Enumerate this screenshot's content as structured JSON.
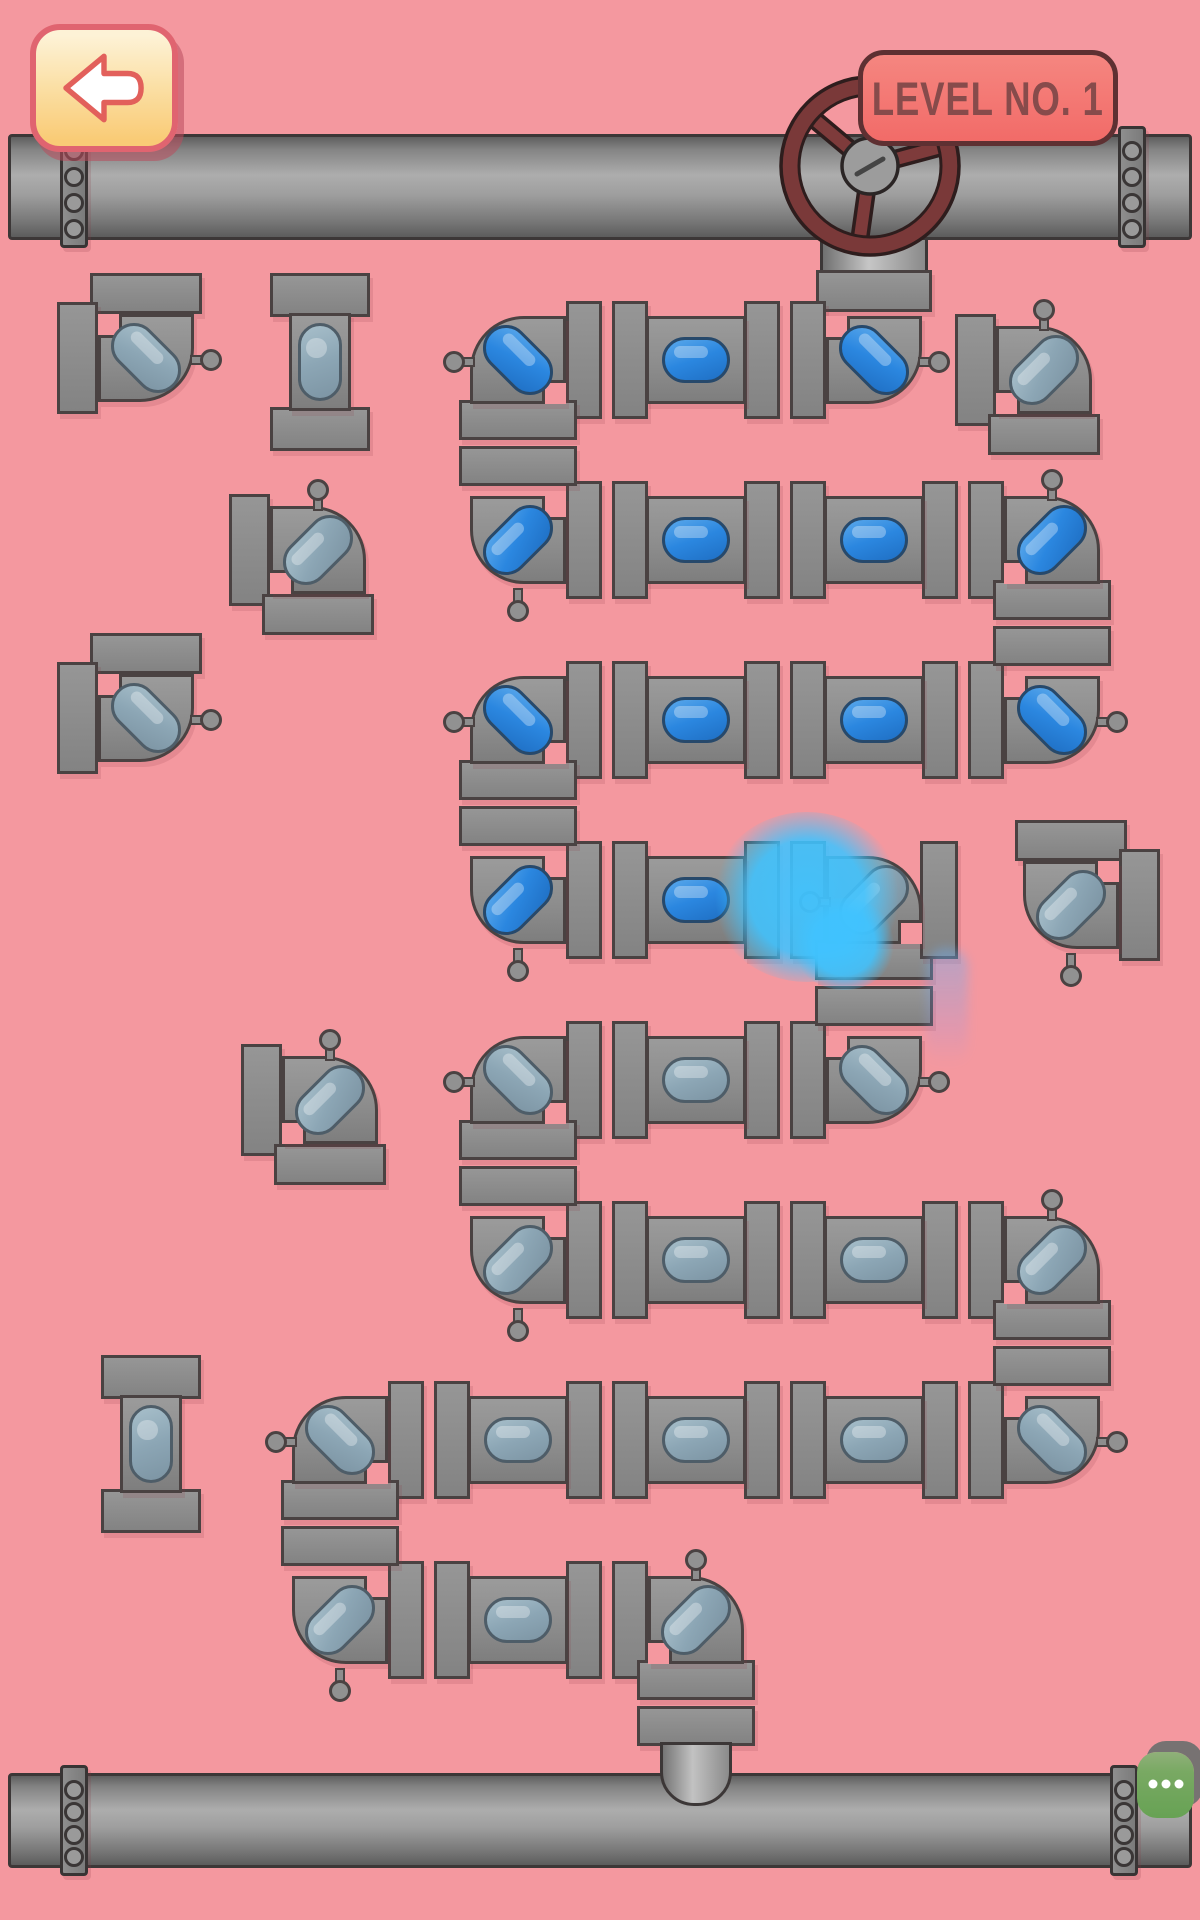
{
  "hud": {
    "back_button": {
      "icon": "arrow-left"
    },
    "level_badge": {
      "text": "LEVEL NO. 1"
    },
    "chat_button": {
      "icon": "ellipsis",
      "dot_count": 3
    }
  },
  "colors": {
    "background": "#F4989F",
    "pipe_outline": "#4A4242",
    "pipe_gray": "#8D8D8D",
    "water_filled": "#2B87E0",
    "water_empty": "#8CA6B5",
    "splash_cyan": "#3EC0FF",
    "valve_red": "#7A3939",
    "badge_fill": "#F2716C",
    "badge_border": "#5E3032",
    "badge_text": "#874B4B",
    "back_border": "#E06470",
    "back_fill": "#FBDFA4",
    "chat_green": "#67A254"
  },
  "scene": {
    "width": 1200,
    "height": 1920,
    "main_pipes": [
      {
        "name": "top-pipe",
        "x": 8,
        "y": 134,
        "w": 1184,
        "h": 106,
        "bands": [
          60,
          1118
        ]
      },
      {
        "name": "bottom-pipe",
        "x": 8,
        "y": 1773,
        "w": 1184,
        "h": 95,
        "bands": [
          60,
          1110
        ]
      }
    ],
    "valve": {
      "cx": 870,
      "cy": 166,
      "r": 89,
      "spokes": [
        140,
        15,
        262
      ],
      "stem": {
        "x": 820,
        "y": 200,
        "w": 108,
        "h": 74
      },
      "flange": {
        "x": 816,
        "y": 270,
        "w": 116,
        "h": 42
      }
    },
    "outlet": {
      "x": 660,
      "y": 1742,
      "w": 72,
      "h": 64
    },
    "joints": [
      {
        "t": "h",
        "x": 607,
        "y": 360
      },
      {
        "t": "h",
        "x": 785,
        "y": 360
      },
      {
        "t": "h",
        "x": 607,
        "y": 540
      },
      {
        "t": "h",
        "x": 785,
        "y": 540
      },
      {
        "t": "h",
        "x": 963,
        "y": 540
      },
      {
        "t": "h",
        "x": 607,
        "y": 720
      },
      {
        "t": "h",
        "x": 785,
        "y": 720
      },
      {
        "t": "h",
        "x": 963,
        "y": 720
      },
      {
        "t": "h",
        "x": 607,
        "y": 900
      },
      {
        "t": "h",
        "x": 785,
        "y": 900
      },
      {
        "t": "h",
        "x": 607,
        "y": 1080
      },
      {
        "t": "h",
        "x": 785,
        "y": 1080
      },
      {
        "t": "h",
        "x": 607,
        "y": 1260
      },
      {
        "t": "h",
        "x": 785,
        "y": 1260
      },
      {
        "t": "h",
        "x": 963,
        "y": 1260
      },
      {
        "t": "h",
        "x": 429,
        "y": 1440
      },
      {
        "t": "h",
        "x": 607,
        "y": 1440
      },
      {
        "t": "h",
        "x": 785,
        "y": 1440
      },
      {
        "t": "h",
        "x": 963,
        "y": 1440
      },
      {
        "t": "h",
        "x": 429,
        "y": 1620
      },
      {
        "t": "h",
        "x": 607,
        "y": 1620
      },
      {
        "t": "v",
        "x": 518,
        "y": 443
      },
      {
        "t": "v",
        "x": 1052,
        "y": 623
      },
      {
        "t": "v",
        "x": 518,
        "y": 803
      },
      {
        "t": "v",
        "x": 874,
        "y": 983
      },
      {
        "t": "v",
        "x": 518,
        "y": 1163
      },
      {
        "t": "v",
        "x": 1052,
        "y": 1343
      },
      {
        "t": "v",
        "x": 340,
        "y": 1523
      },
      {
        "t": "v",
        "x": 696,
        "y": 1703
      }
    ],
    "stub_flanges": [
      {
        "x": 920,
        "y": 841,
        "w": 38,
        "h": 118
      }
    ],
    "pieces": [
      {
        "t": "e",
        "x": 518,
        "y": 360,
        "c": "tl",
        "pin": "left",
        "f": true
      },
      {
        "t": "s",
        "x": 696,
        "y": 360,
        "f": true
      },
      {
        "t": "e",
        "x": 874,
        "y": 360,
        "c": "br",
        "pin": "right",
        "f": true
      },
      {
        "t": "e",
        "x": 518,
        "y": 540,
        "c": "bl",
        "pin": "bottom",
        "f": true
      },
      {
        "t": "s",
        "x": 696,
        "y": 540,
        "f": true
      },
      {
        "t": "s",
        "x": 874,
        "y": 540,
        "f": true
      },
      {
        "t": "e",
        "x": 1052,
        "y": 540,
        "c": "tr",
        "pin": "top",
        "f": true
      },
      {
        "t": "e",
        "x": 1052,
        "y": 720,
        "c": "br",
        "pin": "right",
        "f": true
      },
      {
        "t": "s",
        "x": 874,
        "y": 720,
        "f": true
      },
      {
        "t": "s",
        "x": 696,
        "y": 720,
        "f": true
      },
      {
        "t": "e",
        "x": 518,
        "y": 720,
        "c": "tl",
        "pin": "left",
        "f": true
      },
      {
        "t": "e",
        "x": 518,
        "y": 900,
        "c": "bl",
        "pin": "bottom",
        "f": true
      },
      {
        "t": "s",
        "x": 696,
        "y": 900,
        "f": true
      },
      {
        "t": "e",
        "x": 874,
        "y": 900,
        "c": "tr",
        "pin": "left",
        "f": false,
        "notch": "br"
      },
      {
        "t": "e",
        "x": 874,
        "y": 1080,
        "c": "br",
        "pin": "right",
        "f": false
      },
      {
        "t": "s",
        "x": 696,
        "y": 1080,
        "f": false
      },
      {
        "t": "e",
        "x": 518,
        "y": 1080,
        "c": "tl",
        "pin": "left",
        "f": false
      },
      {
        "t": "e",
        "x": 518,
        "y": 1260,
        "c": "bl",
        "pin": "bottom",
        "f": false
      },
      {
        "t": "s",
        "x": 696,
        "y": 1260,
        "f": false
      },
      {
        "t": "s",
        "x": 874,
        "y": 1260,
        "f": false
      },
      {
        "t": "e",
        "x": 1052,
        "y": 1260,
        "c": "tr",
        "pin": "top",
        "f": false
      },
      {
        "t": "e",
        "x": 1052,
        "y": 1440,
        "c": "br",
        "pin": "right",
        "f": false
      },
      {
        "t": "s",
        "x": 874,
        "y": 1440,
        "f": false
      },
      {
        "t": "s",
        "x": 696,
        "y": 1440,
        "f": false
      },
      {
        "t": "s",
        "x": 518,
        "y": 1440,
        "f": false
      },
      {
        "t": "e",
        "x": 340,
        "y": 1440,
        "c": "tl",
        "pin": "left",
        "f": false
      },
      {
        "t": "e",
        "x": 340,
        "y": 1620,
        "c": "bl",
        "pin": "bottom",
        "f": false
      },
      {
        "t": "s",
        "x": 518,
        "y": 1620,
        "f": false
      },
      {
        "t": "e",
        "x": 696,
        "y": 1620,
        "c": "tr",
        "pin": "top",
        "f": false
      }
    ],
    "loose_pieces": [
      {
        "t": "e",
        "x": 146,
        "y": 358,
        "c": "br",
        "pin": "right"
      },
      {
        "t": "sv",
        "x": 320,
        "y": 362
      },
      {
        "t": "e",
        "x": 318,
        "y": 550,
        "c": "tr",
        "pin": "top"
      },
      {
        "t": "e",
        "x": 146,
        "y": 718,
        "c": "br",
        "pin": "right"
      },
      {
        "t": "e",
        "x": 1044,
        "y": 370,
        "c": "tr",
        "pin": "top"
      },
      {
        "t": "e",
        "x": 1071,
        "y": 905,
        "c": "bl",
        "pin": "bottom"
      },
      {
        "t": "e",
        "x": 330,
        "y": 1100,
        "c": "tr",
        "pin": "top"
      },
      {
        "t": "sv",
        "x": 151,
        "y": 1444
      }
    ],
    "splash": {
      "blobs": [
        {
          "x": 712,
          "y": 812,
          "w": 190,
          "h": 170
        },
        {
          "x": 792,
          "y": 898,
          "w": 104,
          "h": 92
        }
      ]
    },
    "trail": {
      "x": 926,
      "y": 948,
      "w": 42,
      "h": 118
    }
  }
}
